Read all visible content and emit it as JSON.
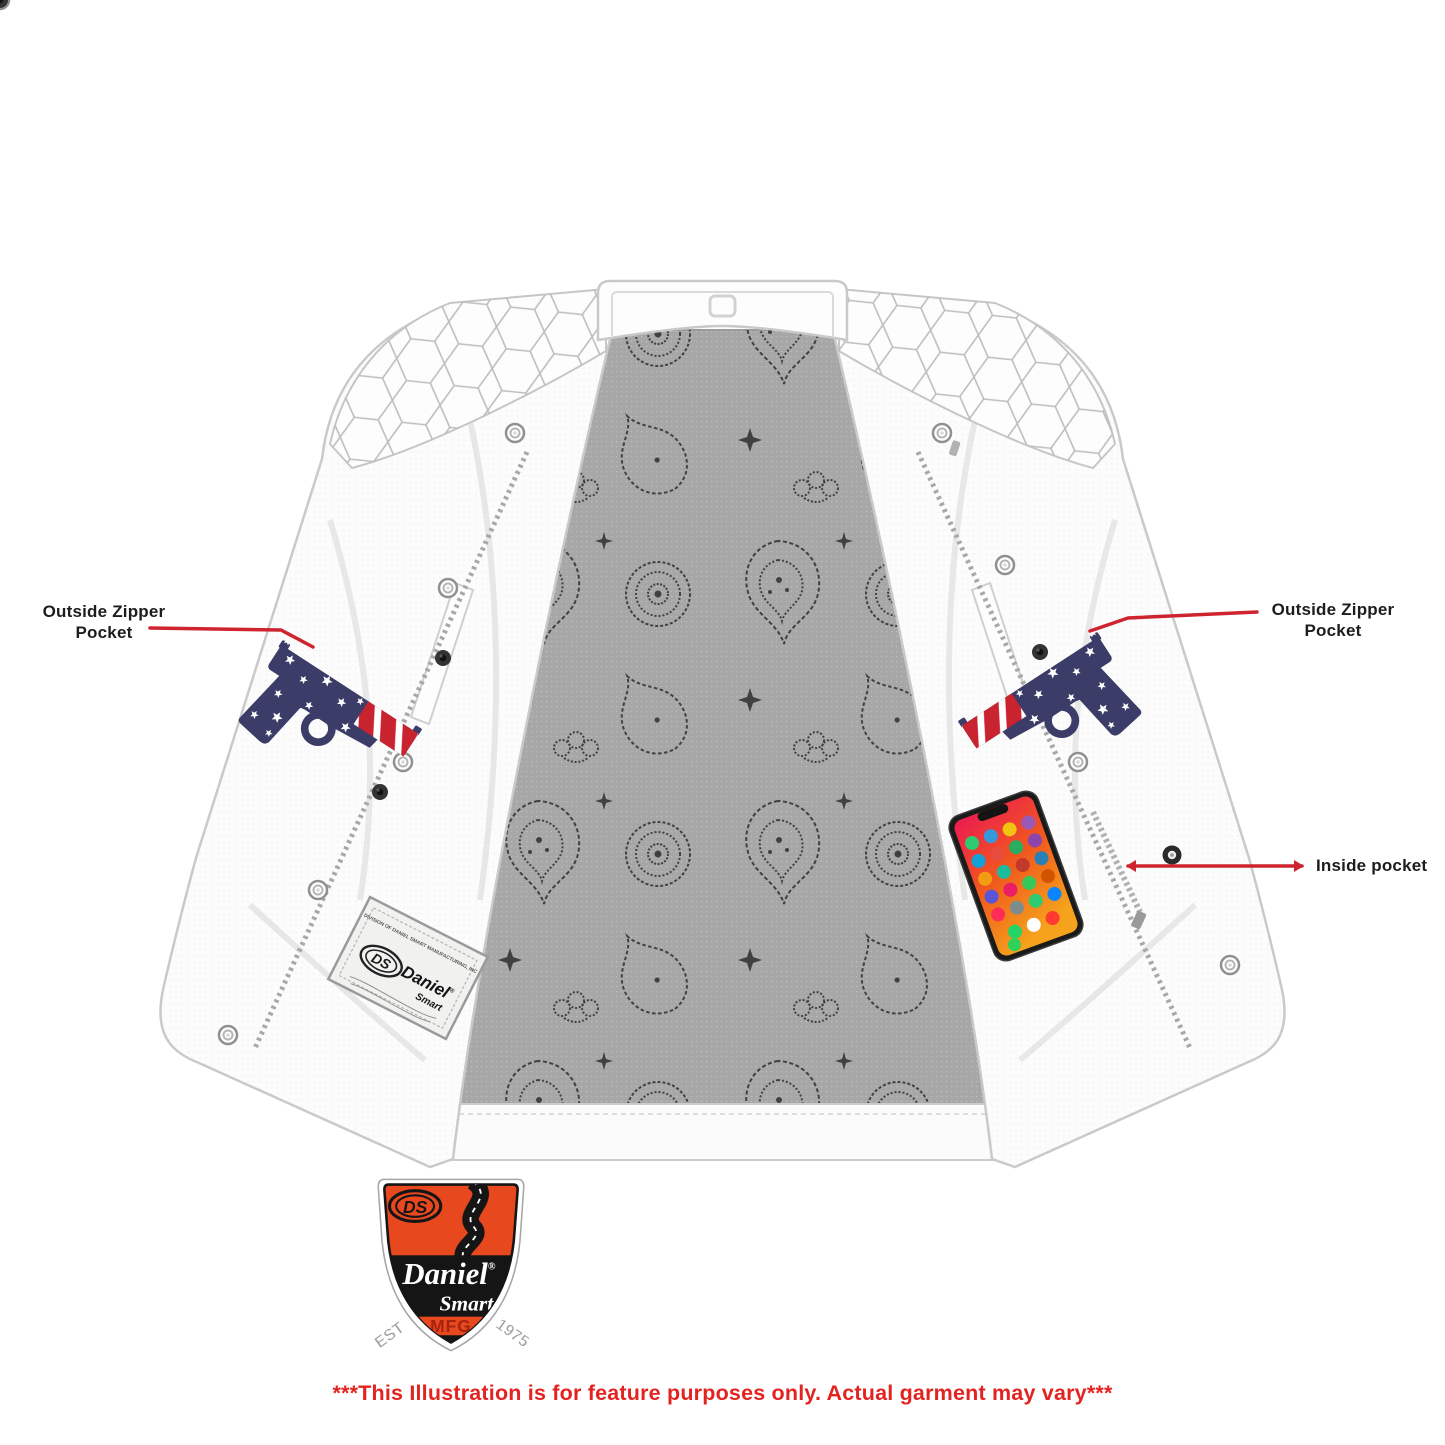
{
  "canvas": {
    "width": 1445,
    "height": 1445,
    "background": "#ffffff"
  },
  "callouts": {
    "left_outside_zipper_pocket": {
      "line1": "Outside Zipper",
      "line2": "Pocket"
    },
    "right_outside_zipper_pocket": {
      "line1": "Outside Zipper",
      "line2": "Pocket"
    },
    "inside_pocket": {
      "label": "Inside pocket"
    },
    "line_color": "#ce2430",
    "text_color": "#1d1d1d"
  },
  "disclaimer": {
    "text": "***This Illustration is for feature purposes only. Actual garment may vary***",
    "color": "#e3231f"
  },
  "brand_logo": {
    "ds_monogram": "DS",
    "name_primary": "Daniel",
    "registered_mark": "®",
    "name_secondary": "Smart",
    "mfg": "MFG",
    "est_label": "EST",
    "est_year": "1975",
    "shield_orange": "#e8481e",
    "shield_black": "#151515",
    "mfg_red": "#a62310"
  },
  "garment_label_patch": {
    "division_text": "DIVISION OF DANIEL SMART MANUFACTURING, INC",
    "ds_monogram": "DS",
    "name_primary": "Daniel",
    "registered_mark": "®",
    "name_secondary": "Smart"
  },
  "illustration": {
    "garment": "white leather club vest shown open",
    "lining": "gray paisley bandana print back panel",
    "props": {
      "left_conceal_pocket": "US flag pistol",
      "right_conceal_pocket": "US flag pistol",
      "inside_pocket": "smartphone"
    },
    "colors": {
      "vest_white": "#fcfcfc",
      "vest_outline": "#c9c9c9",
      "lining_gray": "#a7a7a7",
      "paisley_ink": "#262626",
      "pistol_navy": "#3b3d68",
      "pistol_red": "#c8232e",
      "phone_screen_top": "#ec1a52",
      "phone_screen_bottom": "#f59d15"
    }
  }
}
